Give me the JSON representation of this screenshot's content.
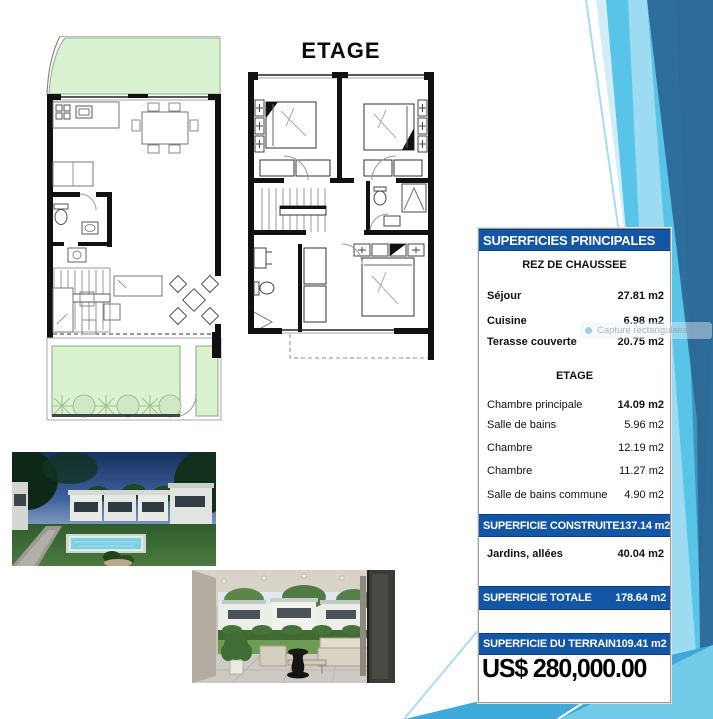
{
  "page": {
    "etage_plan_title": "ETAGE",
    "description": "Real-estate slide with ground-floor plan, upper-floor plan, two renderings and a surfaces table"
  },
  "table": {
    "header": "SUPERFICIES PRINCIPALES",
    "sections": [
      {
        "title": "REZ DE CHAUSSEE",
        "rows": [
          {
            "label": "Séjour",
            "value": "27.81 m2"
          },
          {
            "label": "Cuisine",
            "value": "6.98 m2"
          },
          {
            "label": "Terasse couverte",
            "value": "20.75 m2"
          }
        ]
      },
      {
        "title": "ETAGE",
        "rows": [
          {
            "label": "Chambre principale",
            "value": "14.09 m2"
          },
          {
            "label": "Salle de bains",
            "value": "5.96 m2"
          },
          {
            "label": "Chambre",
            "value": "12.19 m2"
          },
          {
            "label": "Chambre",
            "value": "11.27 m2"
          },
          {
            "label": "Salle de bains commune",
            "value": "4.90 m2"
          }
        ]
      }
    ],
    "totals": [
      {
        "label": "SUPERFICIE CONSTRUITE",
        "value": "137.14 m2"
      },
      {
        "label": "SUPERFICIE TOTALE",
        "value": "178.64 m2"
      },
      {
        "label": "SUPERFICIE DU TERRAIN",
        "value": "109.41 m2"
      }
    ],
    "jardins": {
      "label": "Jardins, allées",
      "value": "40.04 m2"
    },
    "price": "US$ 280,000.00"
  },
  "overlay": {
    "capture_tooltip": "Capture rectangulaire"
  },
  "colors": {
    "bar_blue": "#1356A5",
    "band_dark": "#2F6D9C",
    "band_sky": "#58C5E8",
    "band_pale": "#A9DEF3",
    "plan_green": "#D9F2D0",
    "price_text": "#000000"
  }
}
